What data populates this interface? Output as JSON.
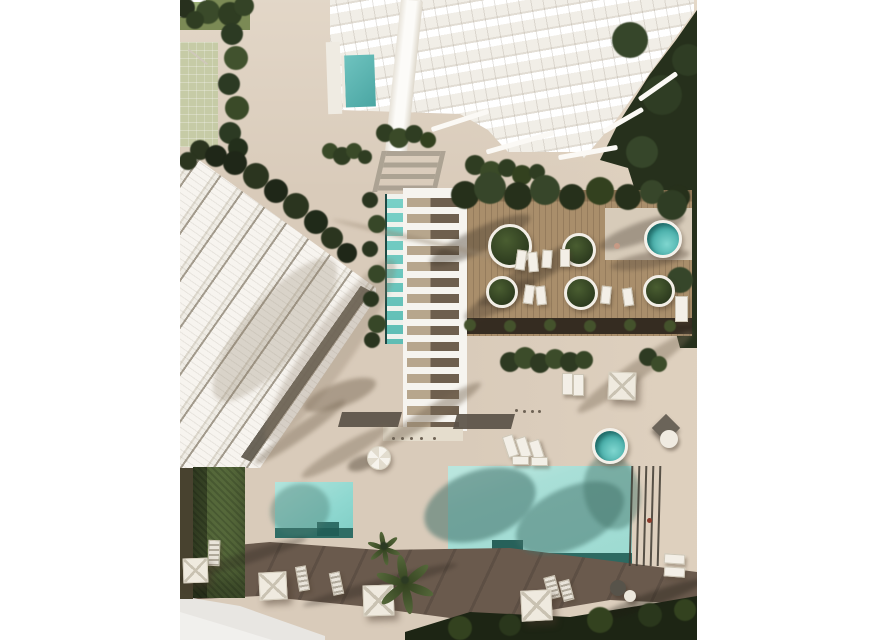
{
  "meta": {
    "width": 878,
    "height": 640,
    "scene_type": "aerial-architectural-render"
  },
  "palette": {
    "margin_white": "#ffffff",
    "paving": "#d9cbba",
    "deck_wood": "#a98e6b",
    "deck_dark_band": "#352c21",
    "tower_white": "#f1eee7",
    "panel_white": "#f7f4ef",
    "pergola_shadow_gray": "#a59c8d",
    "shade_dark": "#5a5146",
    "brown_band": "#6a5a4d",
    "path_light": "#e8e6e2",
    "pool_right_teal": "#a9dfd7",
    "pool_left_teal": "#8fd8d0",
    "pool_edge_dark": "#2d6a62",
    "lap_pool_teal": "#79d1c8",
    "spa_teal": "#49b6b1",
    "tower_pool_teal": "#5fb8b4",
    "tree_dark": "#26301c",
    "tree_mid": "#3a4a29",
    "hedge_green": "#55683a",
    "lawn_pale": "#c6cba6",
    "lawn_dark": "#7b8a55"
  },
  "scene": {
    "shadows": [
      {
        "x": 300,
        "y": 240,
        "rx": 55,
        "ry": 12,
        "rot": -25,
        "c": "rgba(62,52,40,0.40)"
      },
      {
        "x": 355,
        "y": 272,
        "rx": 65,
        "ry": 11,
        "rot": -30,
        "c": "rgba(62,52,40,0.38)"
      },
      {
        "x": 462,
        "y": 232,
        "rx": 45,
        "ry": 10,
        "rot": -20,
        "c": "rgba(62,52,40,0.35)"
      },
      {
        "x": 320,
        "y": 300,
        "rx": 40,
        "ry": 10,
        "rot": -28,
        "c": "rgba(62,52,40,0.35)"
      },
      {
        "x": 250,
        "y": 415,
        "rx": 60,
        "ry": 8,
        "rot": -32,
        "c": "rgba(120,104,85,0.45)"
      },
      {
        "x": 165,
        "y": 452,
        "rx": 50,
        "ry": 8,
        "rot": -30,
        "c": "rgba(120,104,85,0.40)"
      },
      {
        "x": 455,
        "y": 372,
        "rx": 70,
        "ry": 9,
        "rot": -35,
        "c": "rgba(120,104,85,0.40)"
      },
      {
        "x": 240,
        "y": 240,
        "rx": 90,
        "ry": 2,
        "rot": 13,
        "c": "rgba(150,134,112,0.60)"
      },
      {
        "x": 160,
        "y": 395,
        "rx": 38,
        "ry": 12,
        "rot": -20,
        "c": "rgba(124,108,88,0.50)"
      },
      {
        "x": 120,
        "y": 432,
        "rx": 55,
        "ry": 7,
        "rot": -35,
        "c": "rgba(124,108,88,0.45)"
      },
      {
        "x": 150,
        "y": 350,
        "rx": 110,
        "ry": 22,
        "rot": -55,
        "c": "rgba(140,124,104,0.30)"
      },
      {
        "x": 95,
        "y": 330,
        "rx": 90,
        "ry": 30,
        "rot": -50,
        "c": "rgba(140,124,104,0.28)"
      },
      {
        "x": 300,
        "y": 505,
        "rx": 58,
        "ry": 34,
        "rot": -20,
        "c": "rgba(64,112,103,0.55)"
      },
      {
        "x": 390,
        "y": 518,
        "rx": 58,
        "ry": 30,
        "rot": -25,
        "c": "rgba(64,112,103,0.50)"
      },
      {
        "x": 432,
        "y": 492,
        "rx": 28,
        "ry": 38,
        "rot": -12,
        "c": "rgba(64,112,103,0.45)"
      },
      {
        "x": 120,
        "y": 510,
        "rx": 30,
        "ry": 26,
        "rot": -15,
        "c": "rgba(70,120,110,0.40)"
      },
      {
        "x": 60,
        "y": 560,
        "rx": 70,
        "ry": 6,
        "rot": -18,
        "c": "rgba(40,32,25,0.30)"
      },
      {
        "x": 200,
        "y": 585,
        "rx": 80,
        "ry": 6,
        "rot": -15,
        "c": "rgba(40,32,25,0.30)"
      },
      {
        "x": 470,
        "y": 600,
        "rx": 60,
        "ry": 7,
        "rot": -20,
        "c": "rgba(30,25,18,0.35)"
      },
      {
        "x": 470,
        "y": 260,
        "rx": 40,
        "ry": 8,
        "rot": -10,
        "c": "rgba(90,76,60,0.40)"
      },
      {
        "x": 182,
        "y": 463,
        "rx": 15,
        "ry": 7,
        "rot": -20,
        "c": "rgba(90,78,62,0.50)"
      }
    ],
    "bushes": [
      {
        "x": 5,
        "y": 8,
        "r": 10,
        "c": "#27301d"
      },
      {
        "x": 28,
        "y": 12,
        "r": 12,
        "c": "#3a4a2a"
      },
      {
        "x": 50,
        "y": 14,
        "r": 12,
        "c": "#2f3d22"
      },
      {
        "x": 64,
        "y": 6,
        "r": 10,
        "c": "#344326"
      },
      {
        "x": 15,
        "y": 20,
        "r": 9,
        "c": "#2f3d22"
      },
      {
        "x": 52,
        "y": 34,
        "r": 11,
        "c": "#2c3a23"
      },
      {
        "x": 56,
        "y": 58,
        "r": 12,
        "c": "#41522e"
      },
      {
        "x": 49,
        "y": 84,
        "r": 11,
        "c": "#2c3a23"
      },
      {
        "x": 57,
        "y": 108,
        "r": 12,
        "c": "#3a4a28"
      },
      {
        "x": 50,
        "y": 133,
        "r": 11,
        "c": "#2c3a23"
      },
      {
        "x": 58,
        "y": 148,
        "r": 10,
        "c": "#232f1b"
      },
      {
        "x": 20,
        "y": 150,
        "r": 10,
        "c": "#2b351f"
      },
      {
        "x": 36,
        "y": 156,
        "r": 11,
        "c": "#1f2718"
      },
      {
        "x": 8,
        "y": 161,
        "r": 9,
        "c": "#2b351f"
      },
      {
        "x": 55,
        "y": 163,
        "r": 12,
        "c": "#1f2718"
      },
      {
        "x": 76,
        "y": 176,
        "r": 13,
        "c": "#2b351f"
      },
      {
        "x": 96,
        "y": 191,
        "r": 12,
        "c": "#1f2718"
      },
      {
        "x": 116,
        "y": 206,
        "r": 13,
        "c": "#2b351f"
      },
      {
        "x": 136,
        "y": 222,
        "r": 12,
        "c": "#202a19"
      },
      {
        "x": 152,
        "y": 238,
        "r": 11,
        "c": "#2b351f"
      },
      {
        "x": 167,
        "y": 253,
        "r": 10,
        "c": "#1f2718"
      },
      {
        "x": 205,
        "y": 133,
        "r": 9,
        "c": "#2f3d22"
      },
      {
        "x": 219,
        "y": 138,
        "r": 10,
        "c": "#3a4a28"
      },
      {
        "x": 234,
        "y": 134,
        "r": 9,
        "c": "#2f3d22"
      },
      {
        "x": 248,
        "y": 140,
        "r": 8,
        "c": "#33411f"
      },
      {
        "x": 150,
        "y": 151,
        "r": 8,
        "c": "#3a4a28"
      },
      {
        "x": 162,
        "y": 156,
        "r": 9,
        "c": "#2f3d22"
      },
      {
        "x": 174,
        "y": 151,
        "r": 8,
        "c": "#3a4a28"
      },
      {
        "x": 185,
        "y": 157,
        "r": 7,
        "c": "#2f3d22"
      },
      {
        "x": 295,
        "y": 165,
        "r": 10,
        "c": "#2f3d22"
      },
      {
        "x": 311,
        "y": 172,
        "r": 11,
        "c": "#3a4a28"
      },
      {
        "x": 327,
        "y": 168,
        "r": 9,
        "c": "#2f3d22"
      },
      {
        "x": 342,
        "y": 175,
        "r": 10,
        "c": "#33411f"
      },
      {
        "x": 357,
        "y": 172,
        "r": 8,
        "c": "#2f3d22"
      },
      {
        "x": 285,
        "y": 195,
        "r": 14,
        "c": "#26301b"
      },
      {
        "x": 310,
        "y": 188,
        "r": 16,
        "c": "#37462a"
      },
      {
        "x": 338,
        "y": 196,
        "r": 14,
        "c": "#26301b"
      },
      {
        "x": 365,
        "y": 190,
        "r": 15,
        "c": "#37462a"
      },
      {
        "x": 392,
        "y": 197,
        "r": 13,
        "c": "#26301b"
      },
      {
        "x": 420,
        "y": 191,
        "r": 14,
        "c": "#33411f"
      },
      {
        "x": 448,
        "y": 197,
        "r": 13,
        "c": "#26301b"
      },
      {
        "x": 472,
        "y": 192,
        "r": 12,
        "c": "#37462a"
      },
      {
        "x": 498,
        "y": 197,
        "r": 12,
        "c": "#26301b"
      },
      {
        "x": 190,
        "y": 200,
        "r": 8,
        "c": "#2a351f"
      },
      {
        "x": 197,
        "y": 224,
        "r": 9,
        "c": "#374728"
      },
      {
        "x": 190,
        "y": 249,
        "r": 8,
        "c": "#2a351f"
      },
      {
        "x": 197,
        "y": 274,
        "r": 9,
        "c": "#374728"
      },
      {
        "x": 191,
        "y": 299,
        "r": 8,
        "c": "#2a351f"
      },
      {
        "x": 197,
        "y": 324,
        "r": 9,
        "c": "#374728"
      },
      {
        "x": 192,
        "y": 340,
        "r": 8,
        "c": "#2a351f"
      },
      {
        "x": 330,
        "y": 362,
        "r": 10,
        "c": "#2e3a22"
      },
      {
        "x": 345,
        "y": 358,
        "r": 11,
        "c": "#3c4c2a"
      },
      {
        "x": 360,
        "y": 363,
        "r": 10,
        "c": "#2e3a22"
      },
      {
        "x": 375,
        "y": 359,
        "r": 10,
        "c": "#3c4c2a"
      },
      {
        "x": 390,
        "y": 362,
        "r": 10,
        "c": "#2e3a22"
      },
      {
        "x": 404,
        "y": 360,
        "r": 9,
        "c": "#364526"
      },
      {
        "x": 468,
        "y": 357,
        "r": 9,
        "c": "#2e3a22"
      },
      {
        "x": 479,
        "y": 364,
        "r": 8,
        "c": "#3c4c2a"
      },
      {
        "x": 450,
        "y": 40,
        "r": 18,
        "c": "#36462a"
      },
      {
        "x": 482,
        "y": 95,
        "r": 20,
        "c": "#2f3d24"
      },
      {
        "x": 462,
        "y": 152,
        "r": 16,
        "c": "#36462a"
      },
      {
        "x": 492,
        "y": 205,
        "r": 15,
        "c": "#2f3d24"
      },
      {
        "x": 500,
        "y": 280,
        "r": 13,
        "c": "#36462a"
      },
      {
        "x": 508,
        "y": 60,
        "r": 16,
        "c": "#2f3d24"
      },
      {
        "x": 290,
        "y": 325,
        "r": 6,
        "c": "#44522c"
      },
      {
        "x": 330,
        "y": 326,
        "r": 6,
        "c": "#44522c"
      },
      {
        "x": 370,
        "y": 325,
        "r": 6,
        "c": "#44522c"
      },
      {
        "x": 410,
        "y": 326,
        "r": 6,
        "c": "#44522c"
      },
      {
        "x": 450,
        "y": 325,
        "r": 6,
        "c": "#44522c"
      },
      {
        "x": 490,
        "y": 326,
        "r": 6,
        "c": "#44522c"
      },
      {
        "x": 280,
        "y": 628,
        "r": 12,
        "c": "#33421f"
      },
      {
        "x": 330,
        "y": 625,
        "r": 11,
        "c": "#2a371c"
      },
      {
        "x": 420,
        "y": 620,
        "r": 13,
        "c": "#33421f"
      },
      {
        "x": 470,
        "y": 615,
        "r": 12,
        "c": "#2a371c"
      },
      {
        "x": 505,
        "y": 610,
        "r": 11,
        "c": "#33421f"
      }
    ],
    "planters": [
      {
        "x": 327,
        "y": 243,
        "r": 19
      },
      {
        "x": 396,
        "y": 247,
        "r": 14
      },
      {
        "x": 319,
        "y": 289,
        "r": 13
      },
      {
        "x": 398,
        "y": 290,
        "r": 14
      },
      {
        "x": 476,
        "y": 288,
        "r": 13
      }
    ],
    "loungers": [
      {
        "x": 336,
        "y": 250,
        "w": 8,
        "h": 18,
        "rot": 8
      },
      {
        "x": 348,
        "y": 252,
        "w": 8,
        "h": 18,
        "rot": -5
      },
      {
        "x": 362,
        "y": 250,
        "w": 8,
        "h": 16,
        "rot": 4
      },
      {
        "x": 380,
        "y": 249,
        "w": 8,
        "h": 16,
        "rot": 0
      },
      {
        "x": 344,
        "y": 285,
        "w": 8,
        "h": 17,
        "rot": 8
      },
      {
        "x": 356,
        "y": 286,
        "w": 8,
        "h": 17,
        "rot": -6
      },
      {
        "x": 421,
        "y": 286,
        "w": 8,
        "h": 16,
        "rot": 6
      },
      {
        "x": 443,
        "y": 288,
        "w": 8,
        "h": 16,
        "rot": -8
      },
      {
        "x": 382,
        "y": 373,
        "w": 9,
        "h": 20,
        "rot": 0
      },
      {
        "x": 393,
        "y": 374,
        "w": 9,
        "h": 20,
        "rot": 0
      },
      {
        "x": 325,
        "y": 435,
        "w": 9,
        "h": 20,
        "rot": -18
      },
      {
        "x": 338,
        "y": 437,
        "w": 9,
        "h": 19,
        "rot": -18
      },
      {
        "x": 351,
        "y": 440,
        "w": 9,
        "h": 17,
        "rot": -18
      },
      {
        "x": 495,
        "y": 296,
        "w": 11,
        "h": 24,
        "rot": 0
      },
      {
        "x": 332,
        "y": 456,
        "w": 15,
        "h": 7,
        "rot": 0
      },
      {
        "x": 351,
        "y": 457,
        "w": 15,
        "h": 7,
        "rot": 0
      },
      {
        "x": 484,
        "y": 554,
        "w": 19,
        "h": 8,
        "rot": 4
      },
      {
        "x": 484,
        "y": 567,
        "w": 19,
        "h": 8,
        "rot": 4
      },
      {
        "x": 28,
        "y": 540,
        "w": 10,
        "h": 24,
        "rot": 2,
        "v": "striped"
      },
      {
        "x": 117,
        "y": 566,
        "w": 9,
        "h": 23,
        "rot": -10,
        "v": "striped"
      },
      {
        "x": 151,
        "y": 572,
        "w": 9,
        "h": 21,
        "rot": -12,
        "v": "striped"
      },
      {
        "x": 366,
        "y": 576,
        "w": 10,
        "h": 21,
        "rot": -15,
        "v": "striped"
      },
      {
        "x": 381,
        "y": 580,
        "w": 9,
        "h": 19,
        "rot": -15,
        "v": "striped"
      }
    ],
    "umbrellas": [
      {
        "x": 428,
        "y": 372,
        "s": 26,
        "rot": 2
      },
      {
        "x": 3,
        "y": 558,
        "s": 23,
        "rot": -2
      },
      {
        "x": 79,
        "y": 572,
        "s": 26,
        "rot": -3
      },
      {
        "x": 183,
        "y": 585,
        "s": 29,
        "rot": -2
      },
      {
        "x": 341,
        "y": 590,
        "s": 29,
        "rot": -3
      }
    ],
    "spas": [
      {
        "x": 480,
        "y": 236,
        "r": 16
      },
      {
        "x": 427,
        "y": 443,
        "r": 15
      }
    ],
    "round_umbrellas": [
      {
        "x": 198,
        "y": 457,
        "r": 11
      }
    ],
    "dark_umbrellas": [
      {
        "x": 486,
        "y": 428,
        "s": 20,
        "rot": 45
      }
    ],
    "balls": [
      {
        "x": 489,
        "y": 439,
        "r": 9,
        "c": "#f0ebe1"
      },
      {
        "x": 438,
        "y": 588,
        "r": 8,
        "c": "#57534a"
      },
      {
        "x": 450,
        "y": 596,
        "r": 6,
        "c": "#ece7dc"
      }
    ],
    "dots": [
      {
        "x": 212,
        "y": 437
      },
      {
        "x": 221,
        "y": 437
      },
      {
        "x": 230,
        "y": 437
      },
      {
        "x": 240,
        "y": 437
      },
      {
        "x": 253,
        "y": 437
      },
      {
        "x": 335,
        "y": 409
      },
      {
        "x": 343,
        "y": 410
      },
      {
        "x": 351,
        "y": 410
      },
      {
        "x": 358,
        "y": 410
      }
    ],
    "lanes": [
      {
        "x": 450
      },
      {
        "x": 457
      },
      {
        "x": 464
      },
      {
        "x": 471
      },
      {
        "x": 478
      }
    ],
    "rails": [
      {
        "x": 250,
        "y": 118,
        "w": 60,
        "rot": -18
      },
      {
        "x": 305,
        "y": 140,
        "w": 70,
        "rot": -16
      },
      {
        "x": 378,
        "y": 150,
        "w": 60,
        "rot": -10
      },
      {
        "x": 420,
        "y": 118,
        "w": 46,
        "rot": -30
      },
      {
        "x": 455,
        "y": 84,
        "w": 46,
        "rot": -35
      }
    ],
    "palms": [
      {
        "x": 225,
        "y": 580,
        "r": 30
      },
      {
        "x": 204,
        "y": 546,
        "r": 17
      }
    ],
    "markers": [
      {
        "x": 437,
        "y": 246,
        "r": 3,
        "c": "#c79a85"
      },
      {
        "x": 469,
        "y": 520,
        "r": 2.5,
        "c": "#8a3a2a"
      }
    ]
  }
}
